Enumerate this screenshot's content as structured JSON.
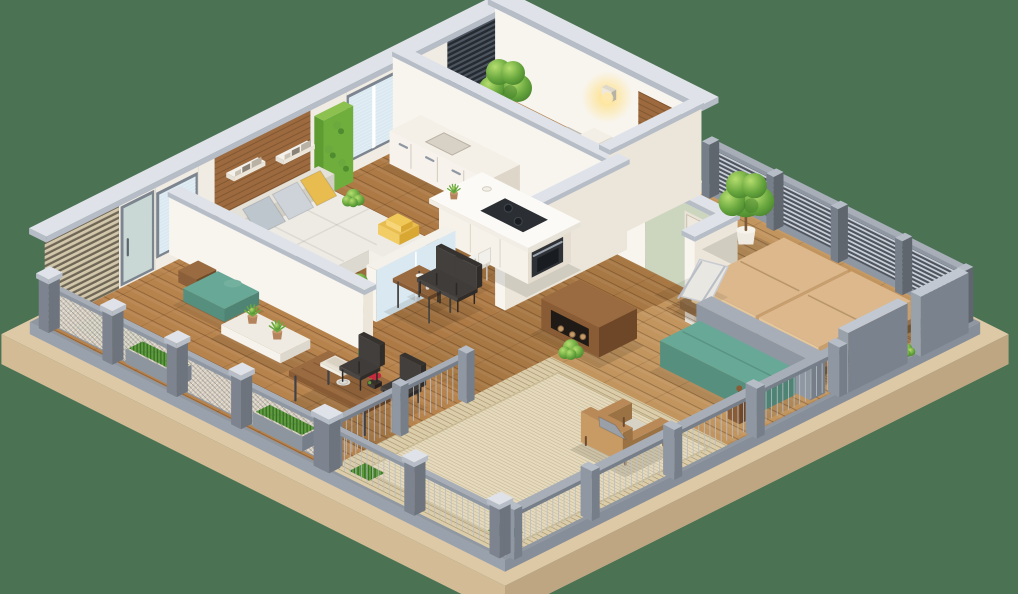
{
  "scene": {
    "title": "3D isometric floor plan render of a furnished apartment with wraparound balcony",
    "style": "dollhouse cutaway, photorealistic 3D render, no visible text",
    "background_color": "#4a7253"
  },
  "palette": {
    "bg": "#4a7253",
    "baseTanTop": "#dec9a7",
    "baseTanL": "#d2bb95",
    "baseTanR": "#bfa682",
    "steel": "#8f97a2",
    "steelDark": "#767e89",
    "steelLight": "#a8aeb8",
    "capTop": "#dfe3e9",
    "capSide": "#b6bdc7",
    "wallLit": "#f8f5ef",
    "wallIn": "#ece6da",
    "wallWhiteU": "#f1ece3",
    "woodWall": "#9c6a3e",
    "woodWallDark": "#7e5430",
    "slatDarkBase": "#262b31",
    "slatPaleBase": "#6f6755",
    "glass": "#d9e8f1",
    "glassDoor": "#cfe0da",
    "glassFrame": "#7c858f",
    "floorBedroom1": "#b48354",
    "floorKitchen": "#ad7a46",
    "floorCorridor": "#a87844",
    "deckBedroom2": "#c2955f",
    "floorBalcony": "#b7834d",
    "deckPale": "#dbcda9",
    "rug": "#e5dabd",
    "sofa": "#edebe4",
    "sofaSide": "#dcd9d0",
    "cushGray": "#bdc5cd",
    "cushGray2": "#cdd3d9",
    "yellow": "#e8bc4e",
    "yellowDeep": "#d9a832",
    "ottoman": "#42464c",
    "ottomanTop": "#4c5057",
    "gold": "#c9a24c",
    "duvet": "#ece4d4",
    "concrete": "#b3aca0",
    "woodStep": "#b98a58",
    "bed2Tan": "#dcb88c",
    "bed2Side": "#c79e6d",
    "bedFrame": "#8a6844",
    "teal": "#67a896",
    "tealDark": "#578f7f",
    "tealSide": "#4f8374",
    "walnut": "#8a5c36",
    "walnutDark": "#6e4628",
    "walnutTop": "#9a6a40",
    "chairDark": "#3f3c3a",
    "chairDarker": "#2f2c2a",
    "leafLight": "#b5dd6e",
    "leafMid": "#6aa83f",
    "leafDark": "#417d2a",
    "potWhite": "#efebe2",
    "potTerra": "#b4825b",
    "greenPanel": "#6fae3c",
    "sage": "#ccd6bf",
    "wire": "#b9bfc6",
    "mesh": "#d8d1c3",
    "red": "#c6283c",
    "glow": "#ffdf7e",
    "white": "#fbfaf6"
  },
  "rooms": [
    {
      "id": "bedroom-top",
      "name": "bedroom with balcony wall",
      "furniture": [
        "double bed on concrete platform with ribbed cream duvet",
        "two white pillows",
        "folded yellow blanket on wood step",
        "wood headboard wall panel",
        "pale slat headboard screen",
        "glowing wall lamp",
        "large potted tree",
        "small white planter",
        "dark slat privacy wall"
      ]
    },
    {
      "id": "kitchen",
      "name": "kitchen",
      "furniture": [
        "white island counter with dark cooktop and built-in oven",
        "white bowl and plant on island",
        "white stool chair",
        "lower cabinet run with steel handles",
        "green living-wall glass panel",
        "double window with blinds"
      ]
    },
    {
      "id": "living-room",
      "name": "living room",
      "furniture": [
        "platform sofa with seat cushions",
        "two gray pillows",
        "yellow pillows",
        "dark gray ottoman with gold base",
        "wood accent wall",
        "two white wall shelves with books",
        "plant behind sofa",
        "white side table with plant",
        "glass partition with white frame",
        "tall potted plant",
        "breakfast table with tea set",
        "two dark dining chairs",
        "window"
      ]
    },
    {
      "id": "hallway",
      "name": "hallway",
      "furniture": [
        "sage green accent wall",
        "cream door",
        "dark walnut console with firewood niche"
      ]
    },
    {
      "id": "bedroom-right",
      "name": "open-air master bedroom",
      "furniture": [
        "platform double bed with two tan mattresses",
        "slatted wood deck",
        "chrome lounge chair",
        "large potted tree",
        "horizontal slat railing",
        "gray parapet walls with plant niche",
        "goblet side table"
      ]
    },
    {
      "id": "balcony-left",
      "name": "wraparound balcony",
      "furniture": [
        "walnut outdoor dining table",
        "two dark chairs",
        "white plate",
        "stacked books",
        "red flower centerpiece",
        "teal lounge cushion",
        "driftwood log",
        "grass mat",
        "white tray bench with two terracotta potted plants",
        "mesh railing with chunky posts",
        "railing planter boxes with shrubs"
      ]
    },
    {
      "id": "terrace",
      "name": "lounge terrace",
      "furniture": [
        "striped pale outdoor rug",
        "wooden armchair with gray cushions",
        "grass tuft planters",
        "wire railing",
        "low teal bench",
        "low gray bench wall"
      ]
    }
  ],
  "structure": {
    "base": "tan plinth slab with gray steel edge band",
    "walls": "white and cream walls with light gray caps",
    "floors": "warm wood plank floors, pale striped deck on terrace"
  }
}
